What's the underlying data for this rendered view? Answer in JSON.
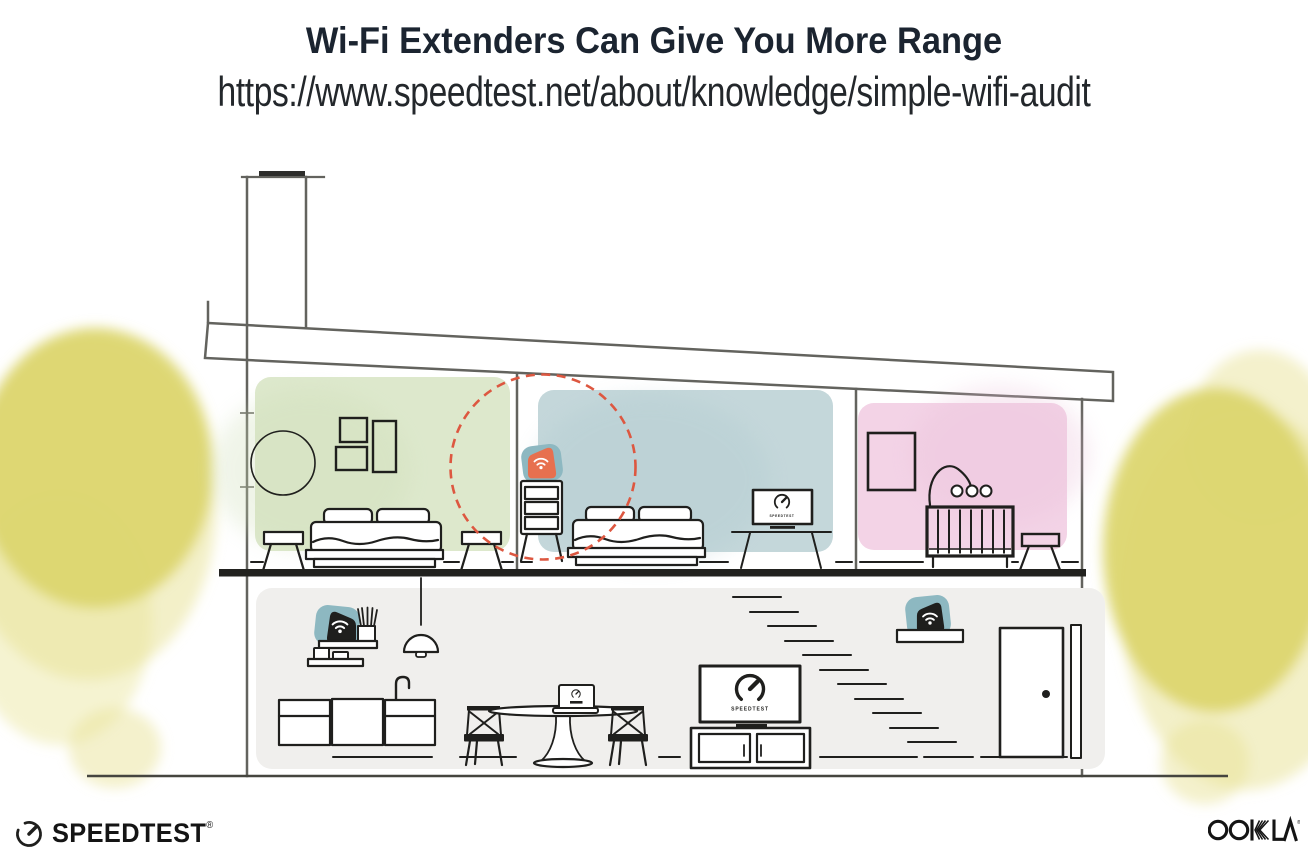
{
  "header": {
    "title": "Wi-Fi Extenders Can Give You More Range",
    "url": "https://www.speedtest.net/about/knowledge/simple-wifi-audit"
  },
  "illustration": {
    "tv_label": "SPEEDTEST",
    "icons": [
      "wifi-icon",
      "speedtest-gauge-icon"
    ],
    "description_labels": {
      "range_circle": "wifi-extender-range",
      "extender_highlight": "orange-wifi-extender-on-dresser"
    }
  },
  "footer": {
    "speedtest_label": "SPEEDTEST",
    "speedtest_reg": "®",
    "ookla_label": "OOKLA",
    "ookla_reg": "®"
  },
  "colors": {
    "ink": "#1f1f1d",
    "wall": "#63635e",
    "room_green": "#dde8cc",
    "room_green_shade": "#cdddb6",
    "room_blue": "#c4d7da",
    "room_blue_shade": "#aec9cf",
    "room_pink": "#f3d3e6",
    "room_pink_shade": "#eabfd9",
    "foliage": "#dcd66f",
    "foliage_light": "#e9e49a",
    "teal": "#8db8c1",
    "orange": "#e7704f",
    "range_red": "#dd5740",
    "floor_bg": "#f0efed",
    "slab": "#22221f",
    "ground": "#45453f",
    "text_dark": "#1b2430",
    "logo_ink": "#141414"
  }
}
